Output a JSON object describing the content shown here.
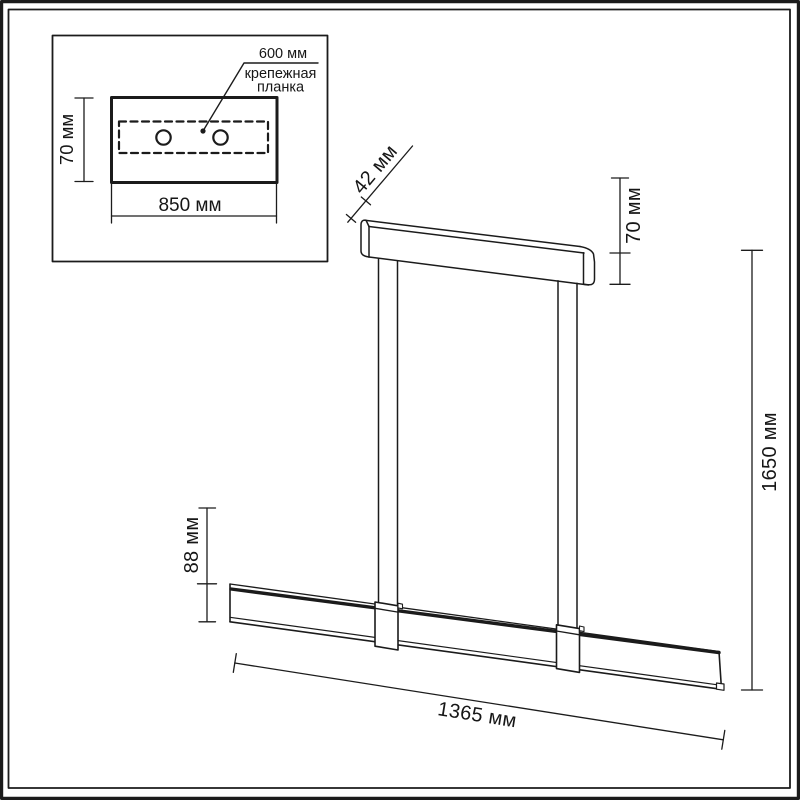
{
  "drawing": {
    "title_hint": "pendant-light-dimension-drawing",
    "inset": {
      "hole_spacing_label": "600 мм",
      "plate_label_line1": "крепежная",
      "plate_label_line2": "планка",
      "plate_height_label": "70 мм",
      "plate_width_label": "850 мм"
    },
    "fixture": {
      "rail_depth_label": "42 мм",
      "rail_height_label": "70 мм",
      "overall_height_label": "1650 мм",
      "bar_height_label": "88 мм",
      "bar_length_label": "1365 мм"
    }
  },
  "colors": {
    "line": "#1b1b1b",
    "text": "#161616",
    "background": "#ffffff"
  }
}
